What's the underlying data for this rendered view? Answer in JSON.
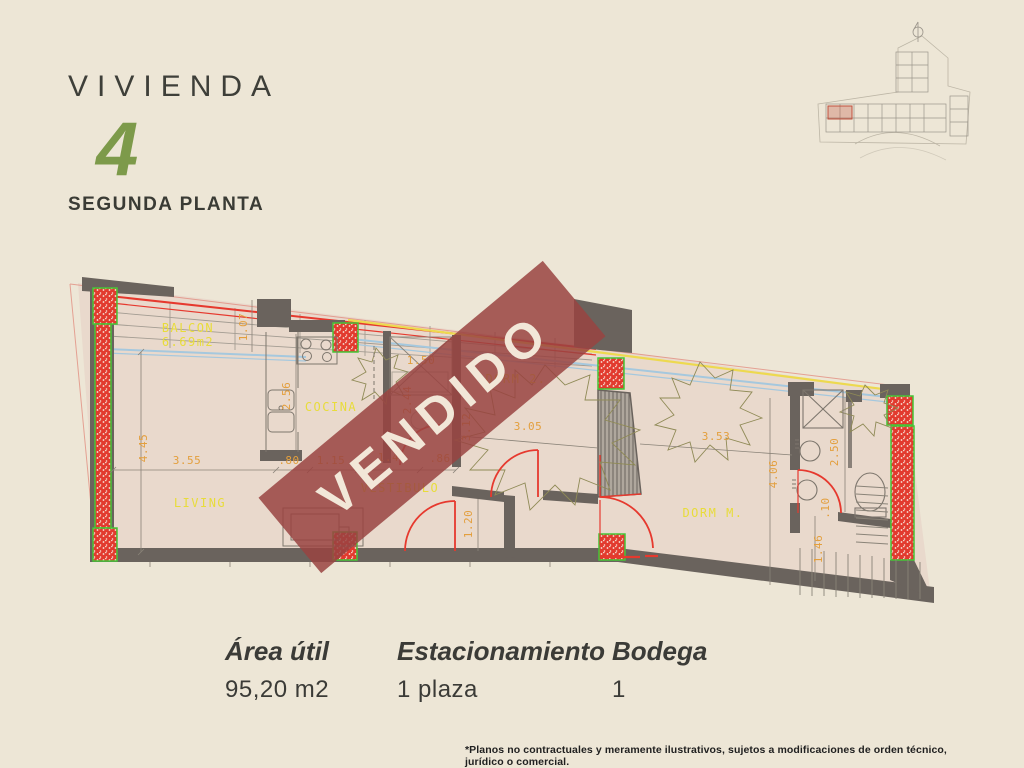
{
  "header": {
    "title": "VIVIENDA",
    "unit_number": "4",
    "floor_label": "SEGUNDA PLANTA"
  },
  "banner": {
    "text": "VENDIDO"
  },
  "plan": {
    "rooms": {
      "balcon": "BALCON",
      "balcon_area": "6.69m2",
      "living": "LIVING",
      "cocina": "COCINA",
      "vestibulo": "VESTIBULO",
      "dorm2": "DORM 2.",
      "dormM": "DORM M."
    },
    "dims": {
      "living_h": "4.45",
      "living_w": "3.55",
      "seg_080": ".80",
      "seg_115": "1.15",
      "seg_149": "1.49",
      "seg_086": ".86",
      "balcony_d": "1.07",
      "kitchen_d": "2.56",
      "hall_w": "1.50",
      "shaft_h": "2.44",
      "bath1_h": "3.12",
      "dorm2_w": "3.05",
      "dormm_w": "3.53",
      "dormm_h": "4.06",
      "bath2_w": "2.50",
      "vest_h": "1.20",
      "stair_w": "1.46",
      "gap": ".10"
    }
  },
  "info": {
    "items": [
      {
        "label": "Área útil",
        "value": "95,20 m2"
      },
      {
        "label": "Estacionamiento",
        "value": "1 plaza"
      },
      {
        "label": "Bodega",
        "value": "1"
      }
    ]
  },
  "footnote": "*Planos no contractuales y meramente ilustrativos, sujetos a modificaciones de orden técnico, jurídico o comercial.",
  "colors": {
    "background": "#EDE6D6",
    "accent_green": "#7D9A4A",
    "banner_red": "#9A4341",
    "plan_floor": "#E9D9CC",
    "wall_gray": "#6A635D",
    "label_yellow": "#E8DC3A",
    "dim_orange": "#E39F3D",
    "line_red": "#E6392E",
    "column_green": "#45C636",
    "glass_blue": "#A5C8DE",
    "facade_yellow": "#EDD94F"
  }
}
